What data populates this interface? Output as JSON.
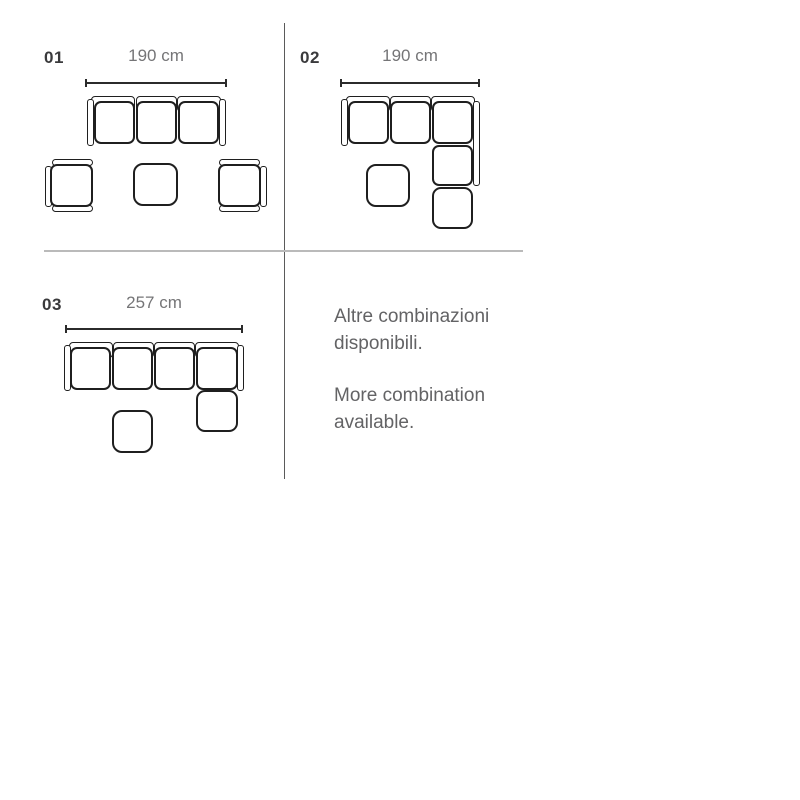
{
  "page": {
    "background": "#ffffff"
  },
  "colors": {
    "label_text": "#3a3a3c",
    "dimension_text": "#757577",
    "body_text": "#636365",
    "outline": "#1f1f1f",
    "dimension_line": "#2b2b2b",
    "vertical_divider": "#5a5a5a",
    "horizontal_divider": "#bababa"
  },
  "configs": [
    {
      "id": "01",
      "dimension": "190 cm",
      "description": "three-seat sofa with two facing armchairs and center pouf"
    },
    {
      "id": "02",
      "dimension": "190 cm",
      "description": "corner sectional sofa with pouf"
    },
    {
      "id": "03",
      "dimension": "257 cm",
      "description": "four-seat sofa with chaise end and pouf"
    }
  ],
  "note": {
    "paragraph1": "Altre combinazioni disponibili.",
    "paragraph2": "More combination available."
  }
}
